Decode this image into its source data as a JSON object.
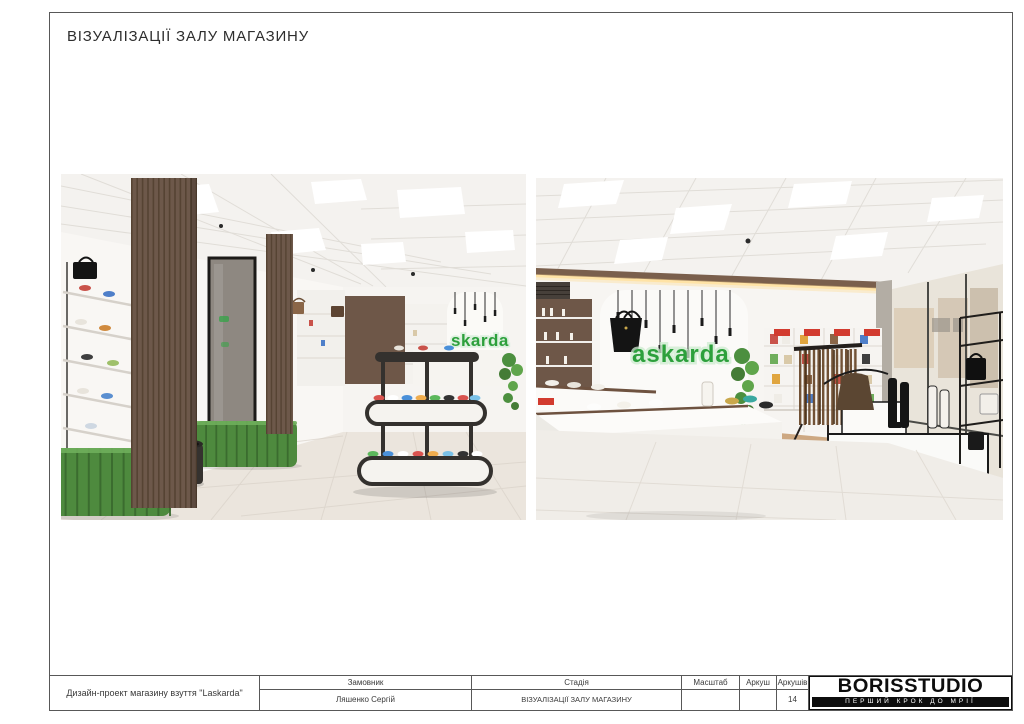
{
  "sheet": {
    "title": "ВІЗУАЛІЗАЦІЇ ЗАЛУ МАГАЗИНУ"
  },
  "renders": {
    "left": {
      "sign_text": "skarda"
    },
    "right": {
      "sign_text": "askarda"
    }
  },
  "title_block": {
    "project_name": "Дизайн-проект магазину взуття \"Laskarda\"",
    "customer_label": "Замовник",
    "customer_value": "Ляшенко Сергій",
    "stage_label": "Стадія",
    "stage_value": "ВІЗУАЛІЗАЦІЇ ЗАЛУ МАГАЗИНУ",
    "scale_label": "Масштаб",
    "scale_value": "",
    "sheet_label": "Аркуш",
    "sheet_value": "",
    "sheets_label": "Аркушів",
    "sheets_value": "14"
  },
  "logo": {
    "name": "BORISSTUDIO",
    "tagline": "ПЕРШИЙ КРОК ДО МРІЇ"
  },
  "colors": {
    "brand_green": "#2da03c",
    "bench_green": "#4e8a3e",
    "wood_brown": "#6d584a",
    "sale_red": "#d23b2f",
    "floor_beige": "#ebe5dd"
  }
}
